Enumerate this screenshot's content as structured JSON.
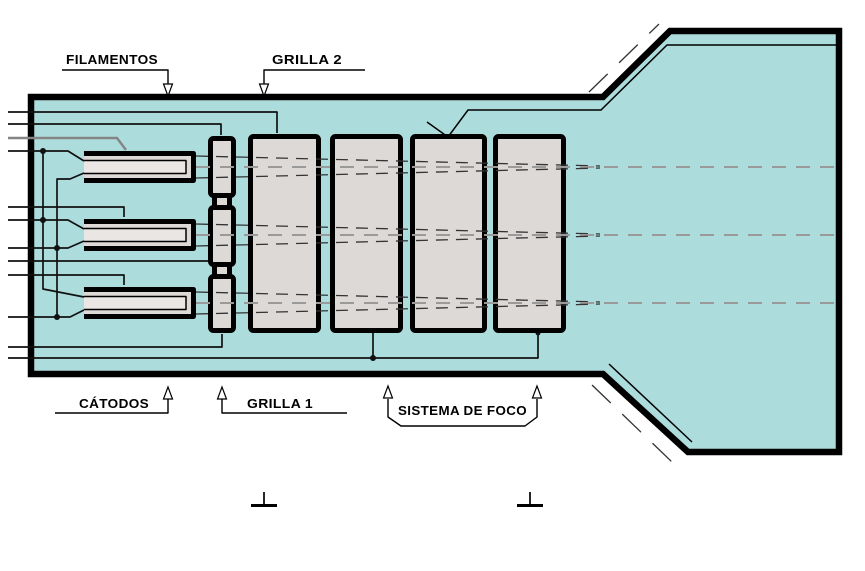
{
  "labels": {
    "filamentos": "FILAMENTOS",
    "grilla_2": "GRILLA 2",
    "catodos": "CÁTODOS",
    "grilla_1": "GRILLA 1",
    "sistema_de_foco": "SISTEMA DE FOCO"
  },
  "colors": {
    "background": "#ffffff",
    "tube_fill": "#addcdd",
    "electrode_fill": "#ddd9d7",
    "filament_fill": "#e9e6e4",
    "outline": "#000000",
    "wire": "#111111",
    "beam_axis": "#9a9a9a"
  }
}
